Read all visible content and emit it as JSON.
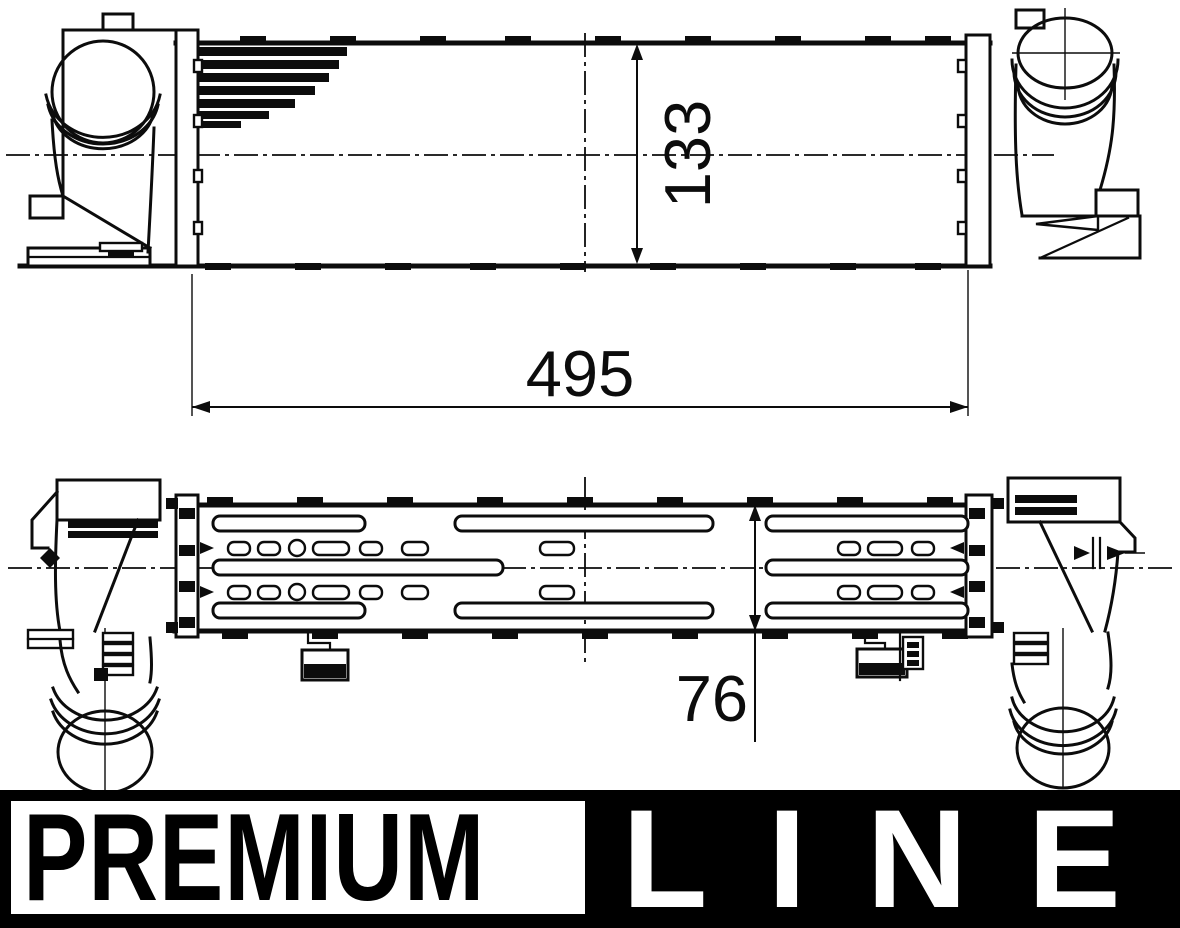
{
  "drawing": {
    "dim_height": "133",
    "dim_length": "495",
    "dim_depth": "76"
  },
  "banner": {
    "premium": "PREMIUM",
    "line": "LINE"
  },
  "colors": {
    "ink": "#0c0c0c",
    "paper": "#ffffff",
    "banner_bg": "#000000",
    "banner_fg": "#ffffff"
  }
}
